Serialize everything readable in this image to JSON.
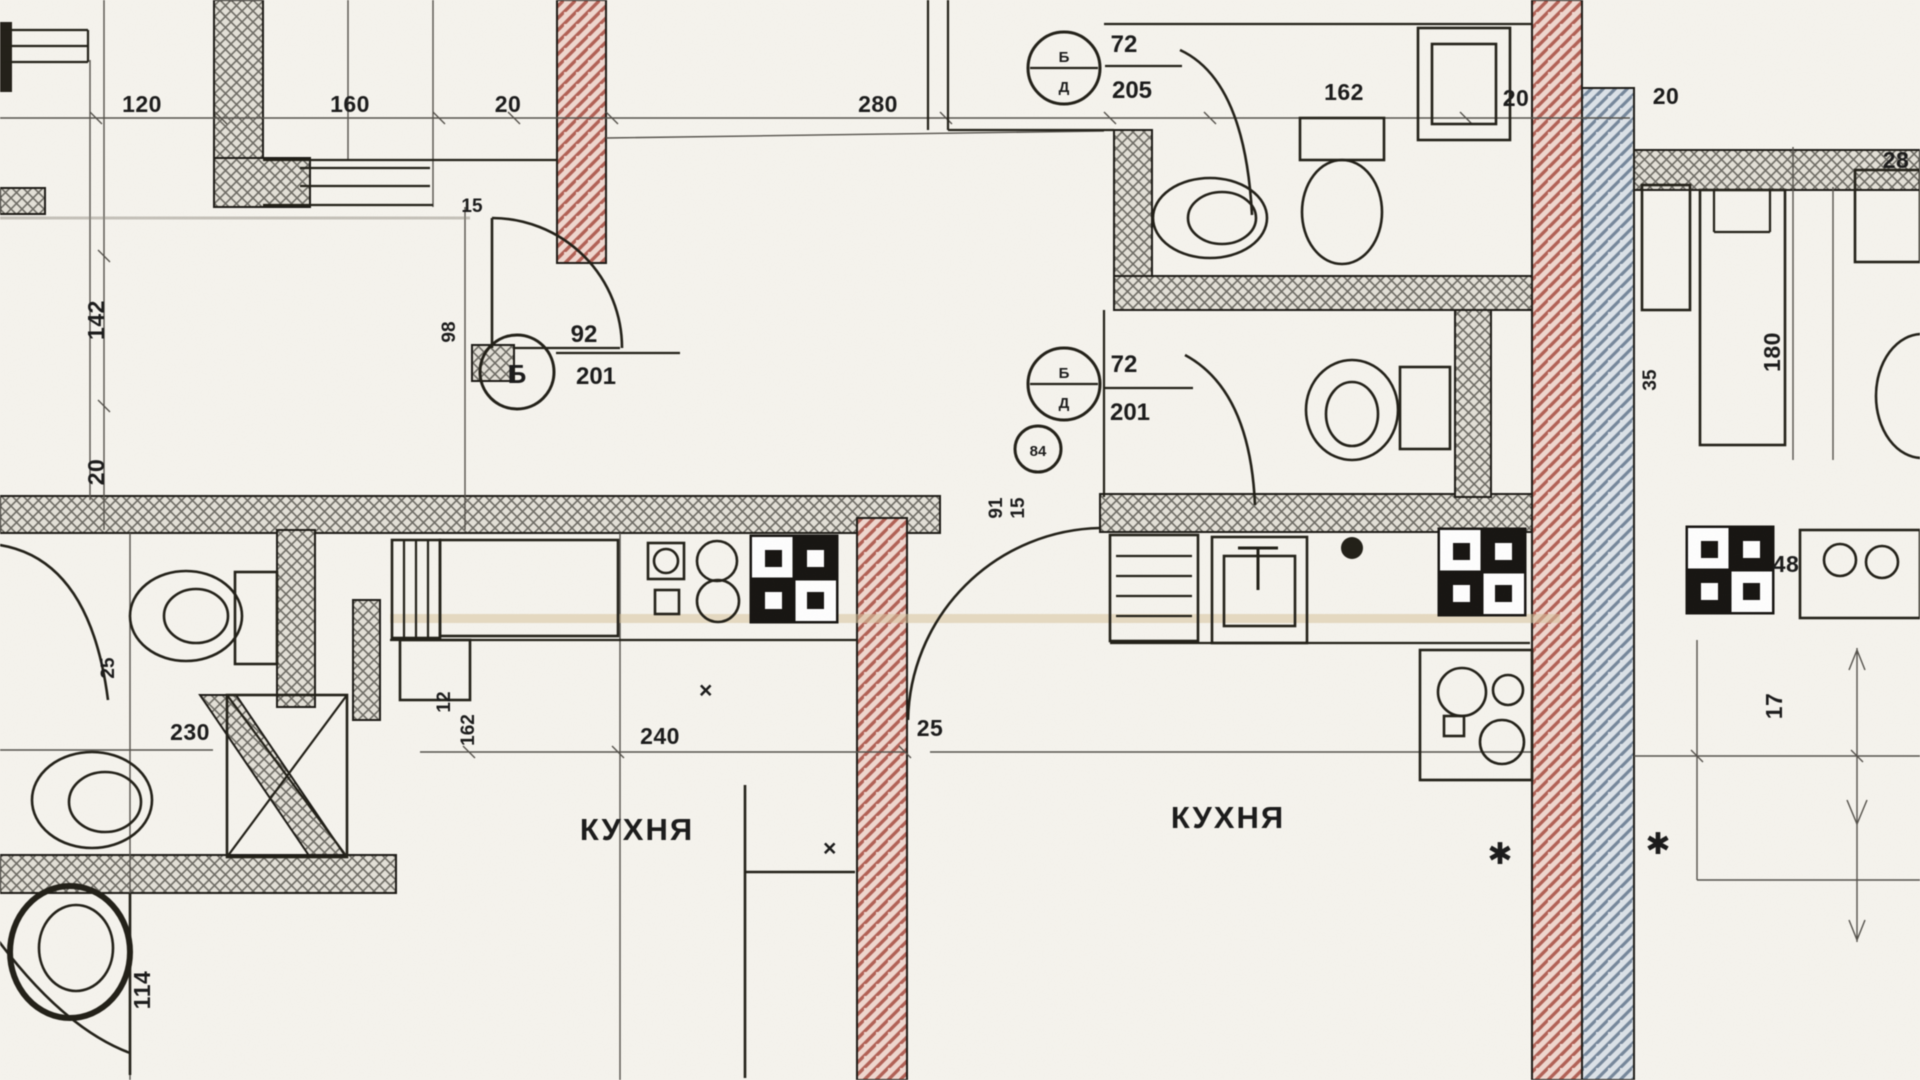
{
  "palette": {
    "paper": "#f6f4ee",
    "ink": "#1b1b1b",
    "wall_hatch": "#6f6d66",
    "wall_fill": "#e4e1d8",
    "red_wall": "#b26156",
    "red_fill": "#f0d8d0",
    "blue_wall": "#76889c",
    "blue_fill": "#dde3e9",
    "counter_tint": "#d8c49e"
  },
  "rooms": {
    "kitchen_left": "КУХНЯ",
    "kitchen_right": "КУХНЯ"
  },
  "markers": {
    "left": {
      "letter": "Б",
      "num": "92",
      "den": "201"
    },
    "mid": {
      "top": "Б",
      "bottom": "Д",
      "num": "72",
      "den": "201"
    },
    "top": {
      "top": "Б",
      "bottom": "Д",
      "num": "72",
      "den": "205"
    },
    "area_circle": "84"
  },
  "dims": {
    "t120": "120",
    "t160": "160",
    "t20a": "20",
    "t280": "280",
    "t162": "162",
    "t20b": "20",
    "t20c": "20",
    "t28": "28",
    "l142": "142",
    "l20": "20",
    "l15": "15",
    "l98": "98",
    "l25": "25",
    "l230": "230",
    "l114": "114",
    "k12": "12",
    "k162": "162",
    "k240": "240",
    "k25": "25",
    "r91": "91",
    "r15": "15",
    "ra35": "35",
    "ra180": "180",
    "ra48": "48",
    "ra17": "17"
  },
  "glyphs": {
    "star1": "✱",
    "star2": "✱",
    "cross1": "×",
    "cross2": "×"
  }
}
